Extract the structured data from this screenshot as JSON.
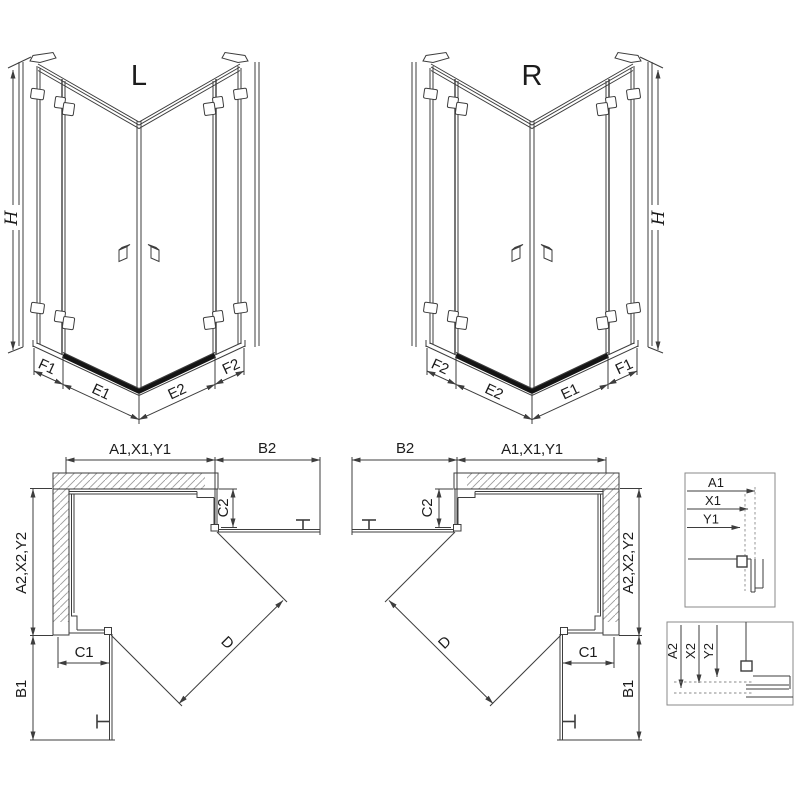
{
  "page": {
    "background": "#ffffff"
  },
  "line_colors": {
    "primary": "#3d3d3d",
    "dark_threshold": "#141414",
    "hatch": "#9b9b9b",
    "detail_box": "#8a8a8a"
  },
  "iso_views": {
    "left": {
      "label": "L",
      "height_dim": "H",
      "bottom_dims": [
        "F1",
        "E1",
        "E2",
        "F2"
      ]
    },
    "right": {
      "label": "R",
      "height_dim": "H",
      "bottom_dims": [
        "F2",
        "E2",
        "E1",
        "F1"
      ]
    }
  },
  "plan_views": {
    "left": {
      "top_width_dim": "A1,X1,Y1",
      "top_door_dim": "B2",
      "top_return_dim": "C2",
      "side_depth_dim": "A2,X2,Y2",
      "bottom_return_dim": "C1",
      "bottom_door_dim": "B1",
      "diagonal_dim": "D"
    },
    "right": {
      "top_width_dim": "A1,X1,Y1",
      "top_door_dim": "B2",
      "top_return_dim": "C2",
      "side_depth_dim": "A2,X2,Y2",
      "bottom_return_dim": "C1",
      "bottom_door_dim": "B1",
      "diagonal_dim": "D"
    }
  },
  "detail_views": {
    "widths": {
      "dims": [
        "A1",
        "X1",
        "Y1"
      ]
    },
    "depths": {
      "dims": [
        "A2",
        "X2",
        "Y2"
      ]
    }
  }
}
